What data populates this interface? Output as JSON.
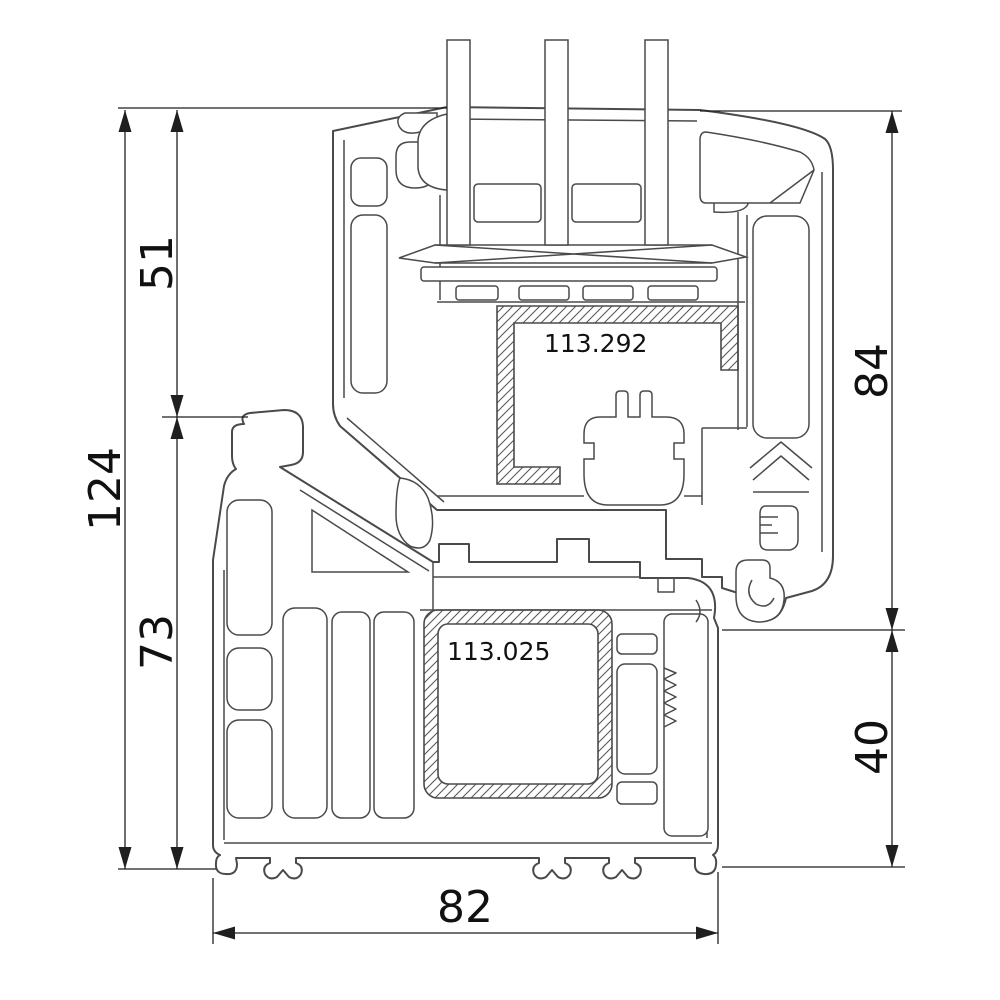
{
  "drawing": {
    "title": "PVC window frame and sash profile cross-section",
    "dimensions": {
      "left_total": "124",
      "left_upper": "51",
      "left_lower": "73",
      "right_upper": "84",
      "right_lower": "40",
      "bottom_width": "82"
    },
    "part_labels": {
      "sash_reinforcement": "113.292",
      "frame_reinforcement": "113.025"
    },
    "colors": {
      "background": "#ffffff",
      "profile_line": "#4a4a4a",
      "dimension_line": "#1f1f1f",
      "text": "#111111"
    }
  }
}
